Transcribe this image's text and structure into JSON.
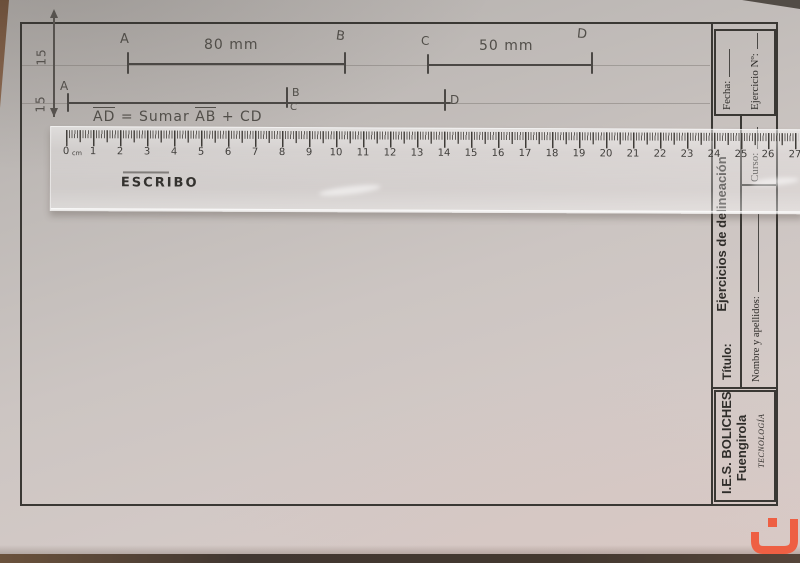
{
  "margins": {
    "top_label": "15",
    "bottom_label": "15"
  },
  "sketch": {
    "seg1": {
      "start": "A",
      "end": "B",
      "length": "80 mm"
    },
    "seg2": {
      "start": "C",
      "end": "D",
      "length": "50 mm"
    },
    "construction": {
      "a": "A",
      "b": "B",
      "c": "C",
      "d": "D"
    },
    "formula": {
      "seg_ad": "AD",
      "mid": "= Sumar",
      "seg_ab": "AB",
      "tail": "+ CD"
    }
  },
  "ruler": {
    "zero": "0",
    "unit": "cm",
    "numbers": [
      "1",
      "2",
      "3",
      "4",
      "5",
      "6",
      "7",
      "8",
      "9",
      "10",
      "11",
      "12",
      "13",
      "14",
      "15",
      "16",
      "17",
      "18",
      "19",
      "20",
      "21",
      "22",
      "23",
      "24",
      "25",
      "26",
      "27"
    ],
    "brand": "ESCRIBO"
  },
  "titleblock": {
    "fecha": "Fecha:",
    "ejercicio": "Ejercicio Nº:",
    "curso": "Curso:",
    "subject": "Ejercicios de delineación",
    "titulo": "Título:",
    "nombre": "Nombre y apellidos:",
    "school_line1": "I.E.S. BOLICHES",
    "school_line2": "Fuengirola",
    "dept": "TECNOLOGÍA"
  },
  "colors": {
    "accent": "#ee5f43",
    "frame": "#3a3834",
    "pencil": "#514e49"
  }
}
